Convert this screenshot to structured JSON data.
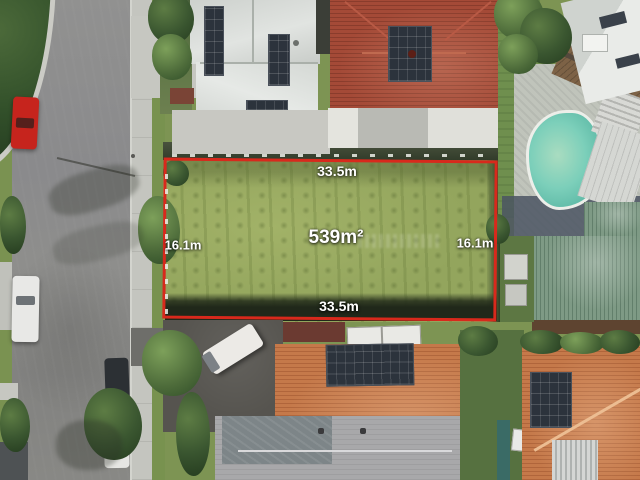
{
  "photo": {
    "kind": "aerial-property-photo"
  },
  "lot": {
    "area": "539m²",
    "frontage_top": "33.5m",
    "frontage_bottom": "33.5m",
    "side_left": "16.1m",
    "side_right": "16.1m"
  },
  "colors": {
    "boundary_red": "#d8291c",
    "label_text": "#ffffff",
    "lot_grass": "#93a55d",
    "road_grey": "#8b8b89",
    "pool_teal": "#6ec3b0",
    "terracotta_roof": "#c5794a",
    "white_roof": "#d9dcd9",
    "green_metal_roof": "#7e9a85",
    "red_car": "#c6241d"
  }
}
